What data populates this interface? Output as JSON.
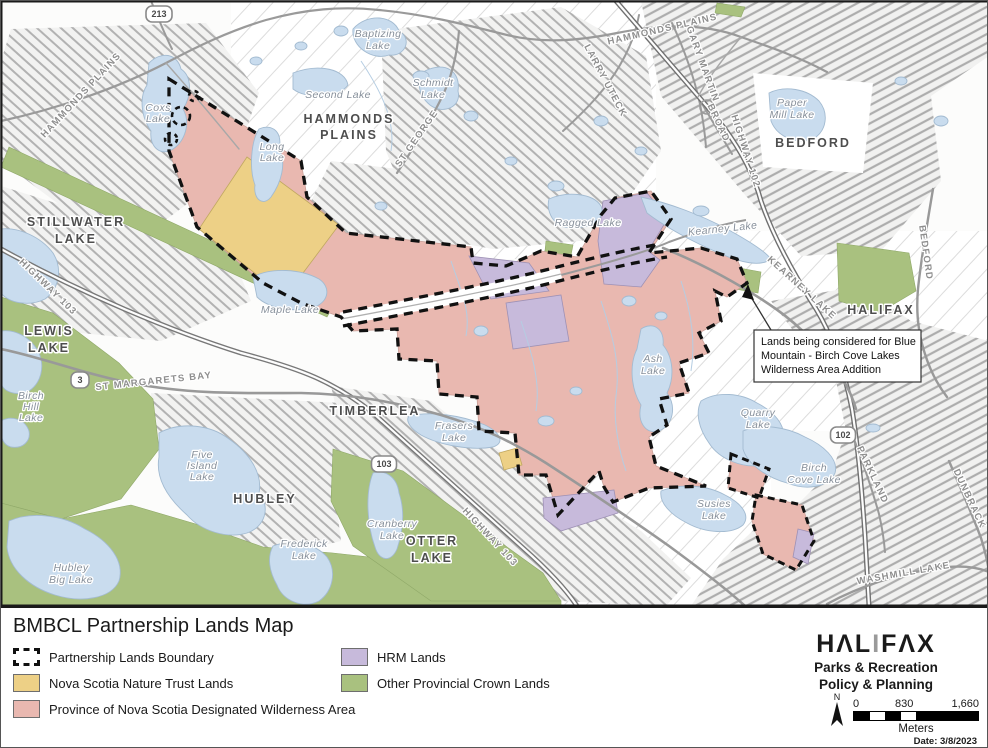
{
  "title": "BMBCL Partnership Lands Map",
  "legend": {
    "items": [
      {
        "key": "boundary",
        "label": "Partnership Lands Boundary"
      },
      {
        "key": "nature_trust",
        "label": "Nova Scotia Nature Trust Lands"
      },
      {
        "key": "wilderness",
        "label": "Province of Nova Scotia Designated Wilderness Area"
      },
      {
        "key": "hrm",
        "label": "HRM Lands"
      },
      {
        "key": "crown",
        "label": "Other Provincial Crown Lands"
      }
    ]
  },
  "branding": {
    "logo_part1": "HΛL",
    "logo_part2": "I",
    "logo_part3": "FΛX",
    "dept_line1": "Parks & Recreation",
    "dept_line2": "Policy & Planning"
  },
  "scalebar": {
    "ticks": [
      "0",
      "830",
      "1,660"
    ],
    "unit": "Meters"
  },
  "north_label": "N",
  "date_label": "Date: 3/8/2023",
  "callout": {
    "lines": [
      "Lands being considered for Blue",
      "Mountain - Birch Cove Lakes",
      "Wilderness Area Addition"
    ]
  },
  "colors": {
    "boundary": "#111111",
    "nature_trust": "#EDD086",
    "wilderness": "#E9B8B0",
    "hrm": "#C7BADB",
    "crown": "#A9C17F",
    "lake": "#C9DCEE"
  },
  "map": {
    "labels": [
      {
        "lines": [
          "HAMMONDS",
          "PLAINS"
        ],
        "x": 348,
        "y": 122,
        "lh": 16,
        "cls": "city"
      },
      {
        "lines": [
          "STILLWATER",
          "LAKE"
        ],
        "x": 75,
        "y": 225,
        "lh": 17,
        "cls": "city"
      },
      {
        "lines": [
          "LEWIS",
          "LAKE"
        ],
        "x": 48,
        "y": 334,
        "lh": 17,
        "cls": "city"
      },
      {
        "lines": [
          "TIMBERLEA"
        ],
        "x": 374,
        "y": 414,
        "cls": "city"
      },
      {
        "lines": [
          "HUBLEY"
        ],
        "x": 264,
        "y": 502,
        "cls": "city"
      },
      {
        "lines": [
          "OTTER",
          "LAKE"
        ],
        "x": 431,
        "y": 544,
        "lh": 17,
        "cls": "city"
      },
      {
        "lines": [
          "BEDFORD"
        ],
        "x": 812,
        "y": 146,
        "cls": "city"
      },
      {
        "lines": [
          "HALIFAX"
        ],
        "x": 880,
        "y": 313,
        "cls": "city"
      },
      {
        "lines": [
          "Coxs",
          "Lake"
        ],
        "x": 157,
        "y": 110,
        "lh": 11,
        "cls": "lake"
      },
      {
        "lines": [
          "Long",
          "Lake"
        ],
        "x": 271,
        "y": 149,
        "lh": 11,
        "cls": "lake"
      },
      {
        "lines": [
          "Baptizing",
          "Lake"
        ],
        "x": 377,
        "y": 36,
        "lh": 12,
        "cls": "lake"
      },
      {
        "lines": [
          "Second Lake"
        ],
        "x": 337,
        "y": 97,
        "cls": "lake"
      },
      {
        "lines": [
          "Schmidt",
          "Lake"
        ],
        "x": 432,
        "y": 85,
        "lh": 12,
        "cls": "lake"
      },
      {
        "lines": [
          "Ragged Lake"
        ],
        "x": 587,
        "y": 225,
        "cls": "lake"
      },
      {
        "lines": [
          "Maple Lake"
        ],
        "x": 289,
        "y": 312,
        "cls": "lake"
      },
      {
        "lines": [
          "Birch",
          "Hill",
          "Lake"
        ],
        "x": 30,
        "y": 398,
        "lh": 11,
        "cls": "lake"
      },
      {
        "lines": [
          "Five",
          "Island",
          "Lake"
        ],
        "x": 201,
        "y": 457,
        "lh": 11,
        "cls": "lake"
      },
      {
        "lines": [
          "Hubley",
          "Big Lake"
        ],
        "x": 70,
        "y": 570,
        "lh": 12,
        "cls": "lake"
      },
      {
        "lines": [
          "Frederick",
          "Lake"
        ],
        "x": 303,
        "y": 546,
        "lh": 12,
        "cls": "lake"
      },
      {
        "lines": [
          "Frasers",
          "Lake"
        ],
        "x": 453,
        "y": 428,
        "lh": 12,
        "cls": "lake"
      },
      {
        "lines": [
          "Cranberry",
          "Lake"
        ],
        "x": 391,
        "y": 526,
        "lh": 12,
        "cls": "lake"
      },
      {
        "lines": [
          "Ash",
          "Lake"
        ],
        "x": 652,
        "y": 361,
        "lh": 12,
        "cls": "lake"
      },
      {
        "lines": [
          "Quarry",
          "Lake"
        ],
        "x": 757,
        "y": 415,
        "lh": 12,
        "cls": "lake"
      },
      {
        "lines": [
          "Birch",
          "Cove Lake"
        ],
        "x": 813,
        "y": 470,
        "lh": 12,
        "cls": "lake"
      },
      {
        "lines": [
          "Susies",
          "Lake"
        ],
        "x": 713,
        "y": 506,
        "lh": 12,
        "cls": "lake"
      },
      {
        "lines": [
          "Paper",
          "Mill Lake"
        ],
        "x": 791,
        "y": 105,
        "lh": 12,
        "cls": "lake"
      },
      {
        "lines": [
          "Kearney Lake"
        ],
        "x": 722,
        "y": 231,
        "rot": -6,
        "cls": "lake"
      },
      {
        "lines": [
          "HAMMONDS PLAINS"
        ],
        "x": 82,
        "y": 96,
        "rot": -47,
        "cls": "road"
      },
      {
        "lines": [
          "HAMMONDS PLAINS"
        ],
        "x": 662,
        "y": 31,
        "rot": -13,
        "cls": "road"
      },
      {
        "lines": [
          "LARRY UTECK"
        ],
        "x": 602,
        "y": 81,
        "rot": 62,
        "cls": "road"
      },
      {
        "lines": [
          "GARY MARTIN"
        ],
        "x": 699,
        "y": 64,
        "rot": 70,
        "cls": "road"
      },
      {
        "lines": [
          "BROAD"
        ],
        "x": 715,
        "y": 123,
        "rot": 65,
        "cls": "road"
      },
      {
        "lines": [
          "HIGHWAY 102"
        ],
        "x": 742,
        "y": 151,
        "rot": 72,
        "cls": "road"
      },
      {
        "lines": [
          "HIGHWAY 103"
        ],
        "x": 45,
        "y": 288,
        "rot": 44,
        "cls": "road"
      },
      {
        "lines": [
          "ST MARGARETS BAY"
        ],
        "x": 153,
        "y": 383,
        "rot": -6,
        "cls": "road"
      },
      {
        "lines": [
          "HIGHWAY 103"
        ],
        "x": 487,
        "y": 538,
        "rot": 47,
        "cls": "road"
      },
      {
        "lines": [
          "KEARNEY LAKE"
        ],
        "x": 799,
        "y": 289,
        "rot": 42,
        "cls": "road"
      },
      {
        "lines": [
          "PARKLAND"
        ],
        "x": 869,
        "y": 475,
        "rot": 65,
        "cls": "road"
      },
      {
        "lines": [
          "DUNBRACK"
        ],
        "x": 966,
        "y": 499,
        "rot": 65,
        "cls": "road"
      },
      {
        "lines": [
          "WASHMILL LAKE"
        ],
        "x": 903,
        "y": 575,
        "rot": -10,
        "cls": "road"
      },
      {
        "lines": [
          "BEDFORD"
        ],
        "x": 922,
        "y": 252,
        "rot": 82,
        "cls": "road"
      },
      {
        "lines": [
          "ST GEORGE"
        ],
        "x": 418,
        "y": 139,
        "rot": -55,
        "cls": "road"
      }
    ],
    "shields": [
      {
        "t": "213",
        "x": 158,
        "y": 13,
        "w": 26
      },
      {
        "t": "3",
        "x": 79,
        "y": 379,
        "w": 18
      },
      {
        "t": "103",
        "x": 383,
        "y": 463,
        "w": 25
      },
      {
        "t": "102",
        "x": 842,
        "y": 434,
        "w": 25
      }
    ]
  }
}
